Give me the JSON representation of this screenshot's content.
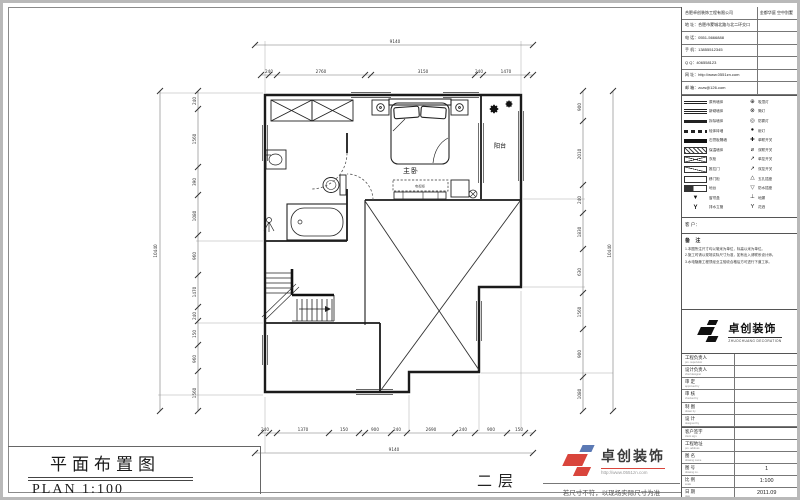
{
  "colors": {
    "logo_red": "#d9453c",
    "logo_blue": "#5b79b4",
    "line": "#1b1b1b"
  },
  "sheet": {
    "title_cn": "平面布置图",
    "title_en": "PLAN  1:100",
    "floor_label": "二层",
    "disclaimer": "若尺寸不符，以现场实际尺寸为准"
  },
  "watermark": {
    "cn": "卓创装饰",
    "url": "http://www.0551zn.com"
  },
  "plan": {
    "labels": {
      "master": "主卧",
      "balcony": "阳台",
      "tv_cabinet": "电视柜"
    },
    "dims": {
      "top_overall": "9140",
      "top": [
        "240",
        "2760",
        "3150",
        "240",
        "1470"
      ],
      "bottom": [
        "240",
        "1370",
        "150",
        "900",
        "240",
        "2690",
        "240",
        "900",
        "150"
      ],
      "bottom_overall": "9140",
      "left": [
        "240",
        "1560",
        "390",
        "1080",
        "960",
        "1470",
        "240",
        "150",
        "960",
        "1560"
      ],
      "left_overall": "10440",
      "right": [
        "900",
        "2010",
        "240",
        "1830",
        "630",
        "1560",
        "900",
        "1080"
      ],
      "right_overall": "10440"
    }
  },
  "titleblock": {
    "company_row": {
      "left": "合肥卓创装饰工程有限公司",
      "right": "金都华庭 空中别墅"
    },
    "info_rows": [
      "地 址：合肥市蒙城北路与北二环交口",
      "电 话：0551-5666888",
      "手 机：13855512345",
      "Q  Q：406558123",
      "网 址：http://www.0551zn.com",
      "邮 箱：zczs@126.com"
    ],
    "legend_left": [
      {
        "style": "ln-dbl",
        "label": "原有墙体"
      },
      {
        "style": "ln-tri3",
        "label": "新砌墙体"
      },
      {
        "style": "ln-thick",
        "label": "拆除墙体"
      },
      {
        "style": "ln-blocks",
        "label": "轻体砖墙"
      },
      {
        "style": "ln-dark",
        "label": "石膏板隔墙"
      },
      {
        "style": "ln-hatch",
        "label": "保温墙体"
      },
      {
        "style": "ln-xbox",
        "label": "衣柜"
      },
      {
        "style": "ln-dbox",
        "label": "推拉门"
      },
      {
        "style": "ln-obox",
        "label": "移门柜"
      },
      {
        "style": "ln-fbox",
        "label": "地台"
      },
      {
        "style": "sym-tri",
        "label": "窗帘盒"
      },
      {
        "style": "sym-hook",
        "label": "排水立管"
      }
    ],
    "legend_right": [
      {
        "icon": "⊕",
        "label": "吸顶灯"
      },
      {
        "icon": "⊗",
        "label": "筒灯"
      },
      {
        "icon": "◎",
        "label": "防雾灯"
      },
      {
        "icon": "●",
        "label": "射灯"
      },
      {
        "icon": "✚",
        "label": "单联开关"
      },
      {
        "icon": "⌀",
        "label": "双联开关"
      },
      {
        "icon": "↗",
        "label": "单控开关"
      },
      {
        "icon": "↗",
        "label": "双控开关"
      },
      {
        "icon": "△",
        "label": "五孔插座"
      },
      {
        "icon": "▽",
        "label": "防水插座"
      },
      {
        "icon": "⊥",
        "label": "地漏"
      },
      {
        "icon": "Y",
        "label": "花洒"
      }
    ],
    "client_label": "客 户：",
    "notes_title": "备 注",
    "notes": [
      "1.本图所注尺寸均以毫米为单位，标高以米为单位。",
      "2.施工时请以现场实际尺寸为准，如有出入请联系设计师。",
      "3.水电隐蔽工程须经业主验收合格后方可进行下道工序。"
    ],
    "logo": {
      "cn": "卓创装饰",
      "en": "ZHUOCHUANG DECORATION"
    },
    "sign_rows": [
      {
        "cn": "工程负责人",
        "en": "pro. supervisor"
      },
      {
        "cn": "设计负责人",
        "en": "chief designer"
      },
      {
        "cn": "审  定",
        "en": "approved by"
      },
      {
        "cn": "审  核",
        "en": "checked by"
      },
      {
        "cn": "制  图",
        "en": "drawn by"
      },
      {
        "cn": "设  计",
        "en": "designed by"
      }
    ],
    "foot_rows": [
      {
        "cn": "客户签字",
        "en": "client sign.",
        "value": ""
      },
      {
        "cn": "工程地址",
        "en": "pro. address",
        "value": ""
      },
      {
        "cn": "图  名",
        "en": "drawing name",
        "value": ""
      },
      {
        "cn": "图  号",
        "en": "drawing no.",
        "value": "1"
      },
      {
        "cn": "比  例",
        "en": "scale",
        "value": "1:100"
      },
      {
        "cn": "日  期",
        "en": "date",
        "value": "2011.09"
      }
    ]
  }
}
